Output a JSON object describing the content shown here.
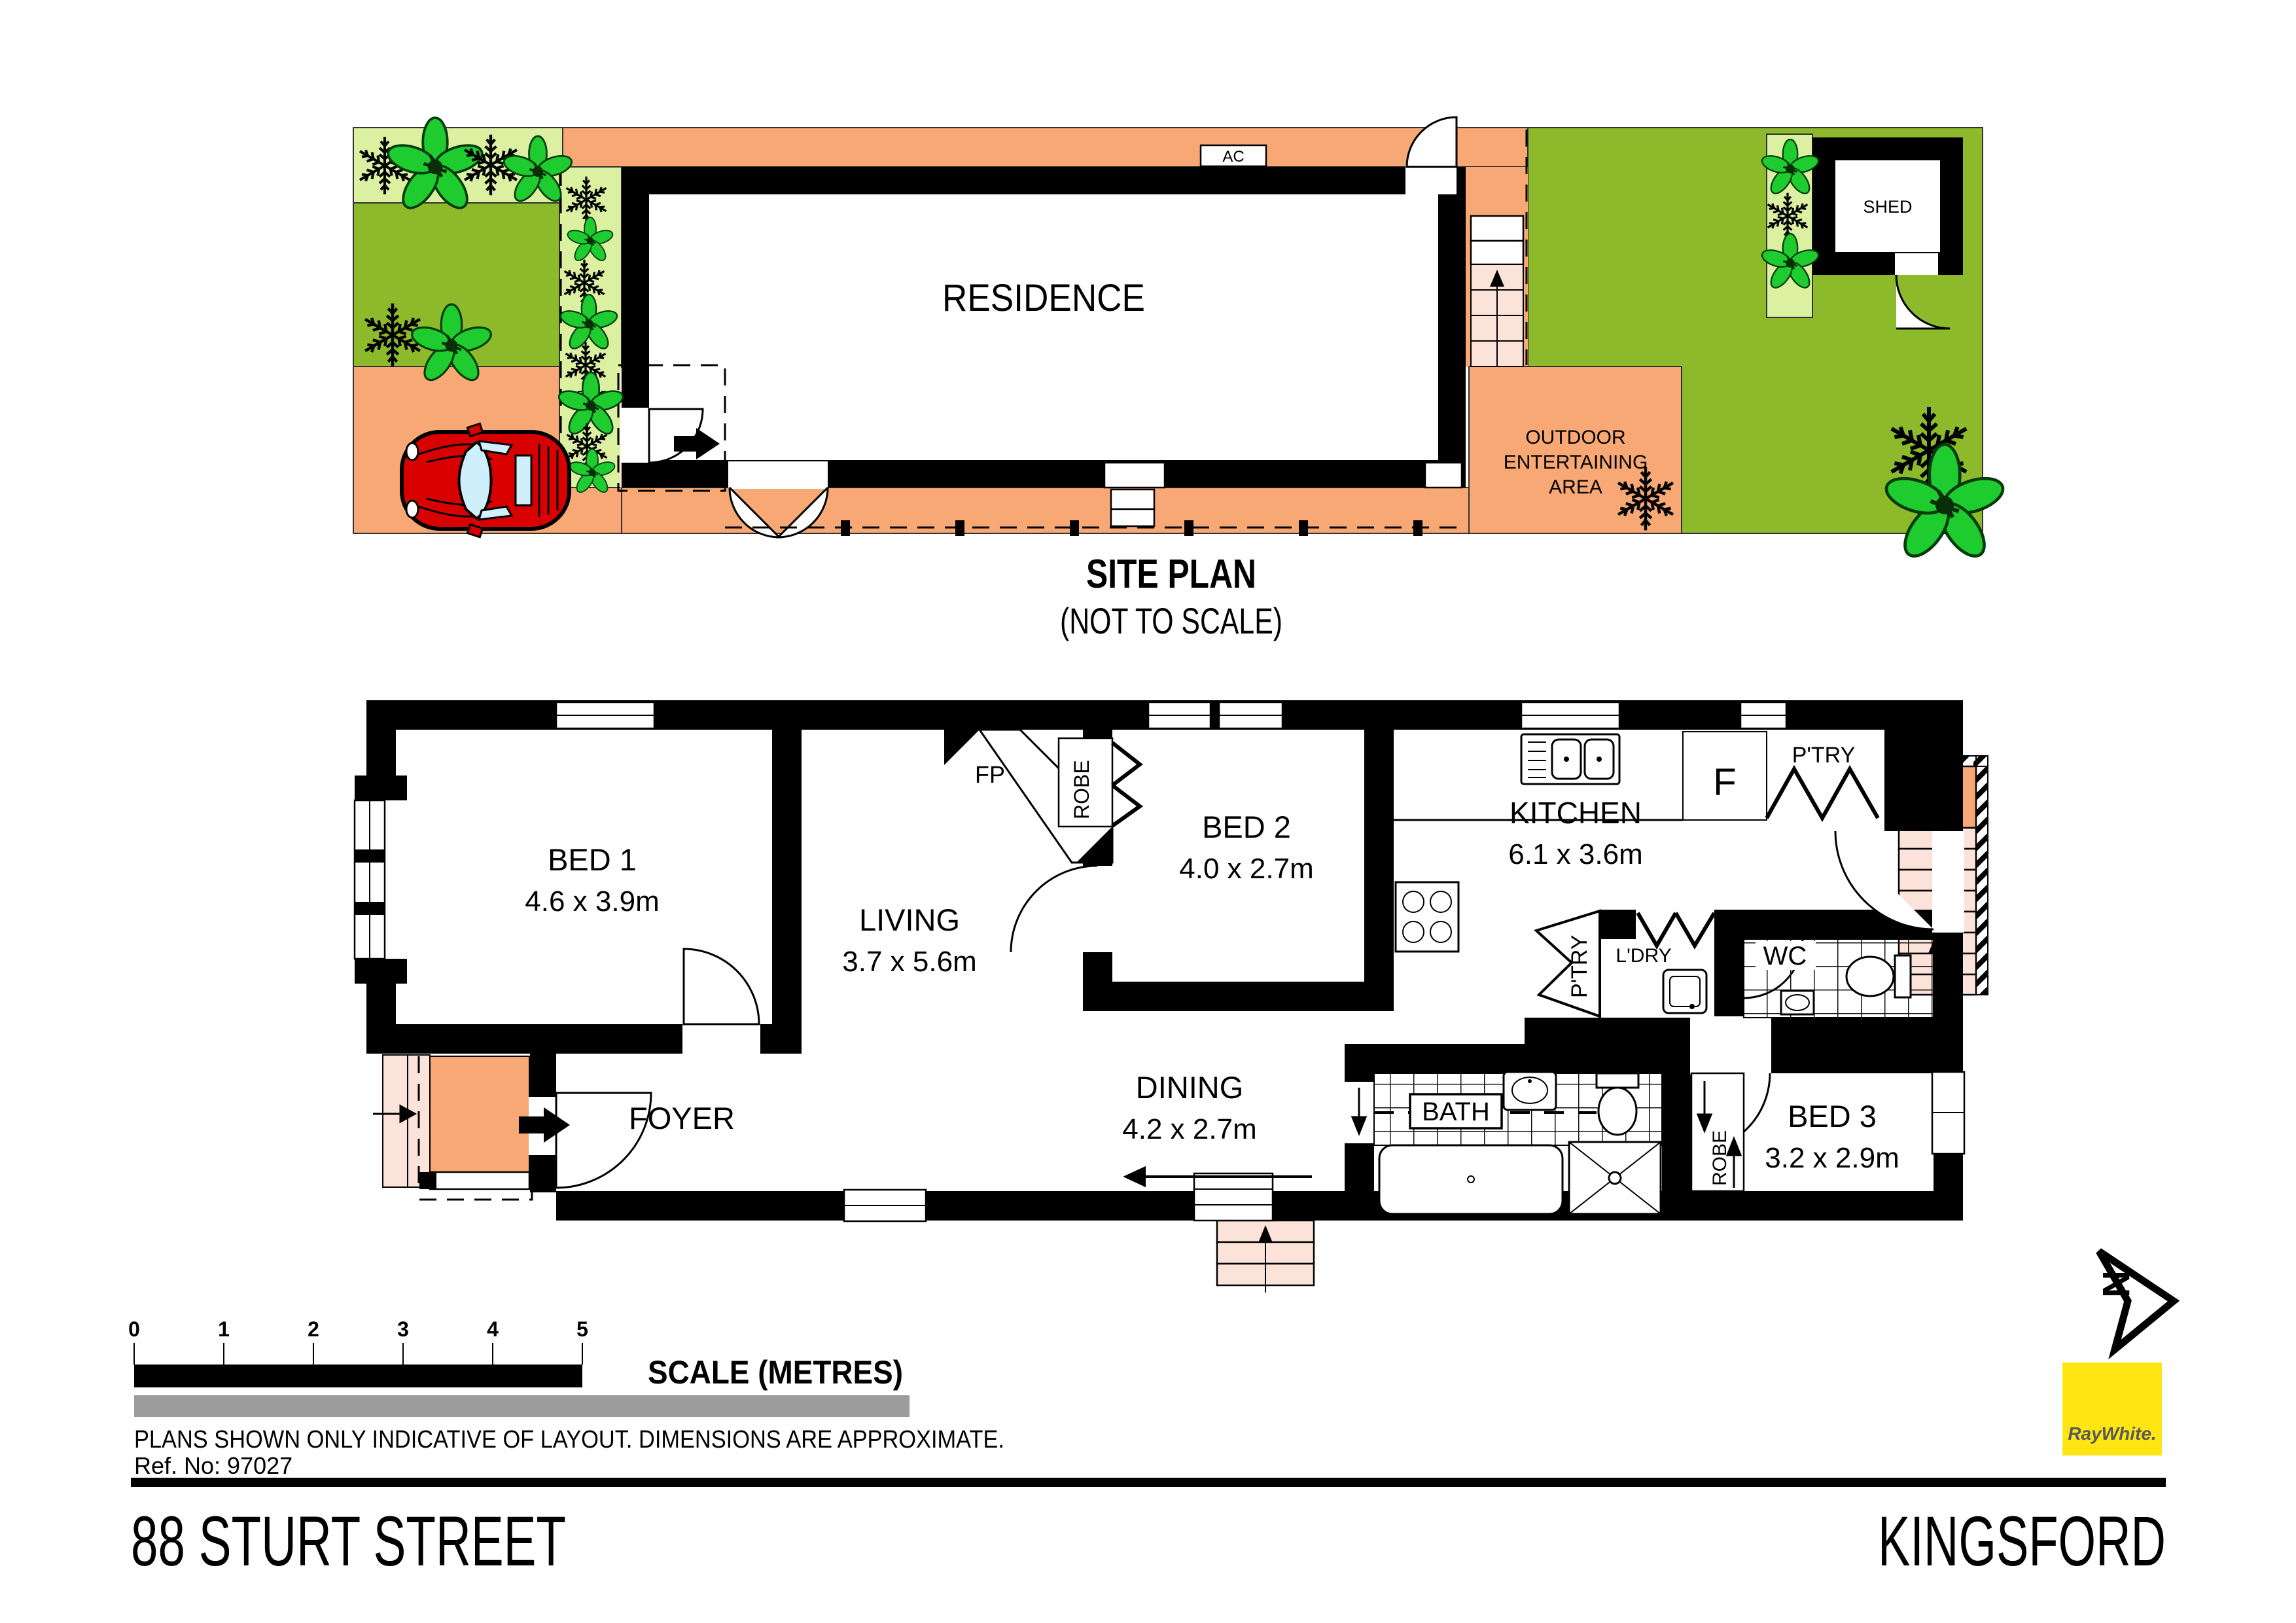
{
  "site_plan": {
    "title": "SITE PLAN",
    "subtitle": "(NOT TO SCALE)",
    "residence": "RESIDENCE",
    "ac": "AC",
    "porch": "PORCH",
    "shed": "SHED",
    "outdoor1": "OUTDOOR",
    "outdoor2": "ENTERTAINING",
    "outdoor3": "AREA"
  },
  "floor_plan": {
    "bed1_name": "BED 1",
    "bed1_dims": "4.6 x 3.9m",
    "living_name": "LIVING",
    "living_dims": "3.7 x 5.6m",
    "foyer": "FOYER",
    "bed2_name": "BED 2",
    "bed2_dims": "4.0 x 2.7m",
    "kitchen_name": "KITCHEN",
    "kitchen_dims": "6.1 x 3.6m",
    "dining_name": "DINING",
    "dining_dims": "4.2 x 2.7m",
    "bed3_name": "BED 3",
    "bed3_dims": "3.2 x 2.9m",
    "bath": "BATH",
    "wc": "WC",
    "ldry": "L'DRY",
    "ptry": "P'TRY",
    "robe": "ROBE",
    "fp": "FP",
    "fridge": "F"
  },
  "scale_bar": {
    "ticks": [
      "0",
      "1",
      "2",
      "3",
      "4",
      "5"
    ],
    "label": "SCALE (METRES)"
  },
  "notes": {
    "disclaimer": "PLANS SHOWN ONLY INDICATIVE OF LAYOUT.  DIMENSIONS ARE APPROXIMATE.",
    "ref": "Ref. No: 97027"
  },
  "footer": {
    "address": "88 STURT STREET",
    "suburb": "KINGSFORD"
  },
  "north": {
    "label": "N"
  },
  "brand": {
    "name": "RayWhite.",
    "color": "#FFE512"
  },
  "colors": {
    "paving": "#F7A874",
    "steps": "#FBE3D9",
    "lawn": "#8CBA2B",
    "garden": "#DCF0A2",
    "plant": "#1FCC2F",
    "grey_bar": "#9C9C9C"
  }
}
